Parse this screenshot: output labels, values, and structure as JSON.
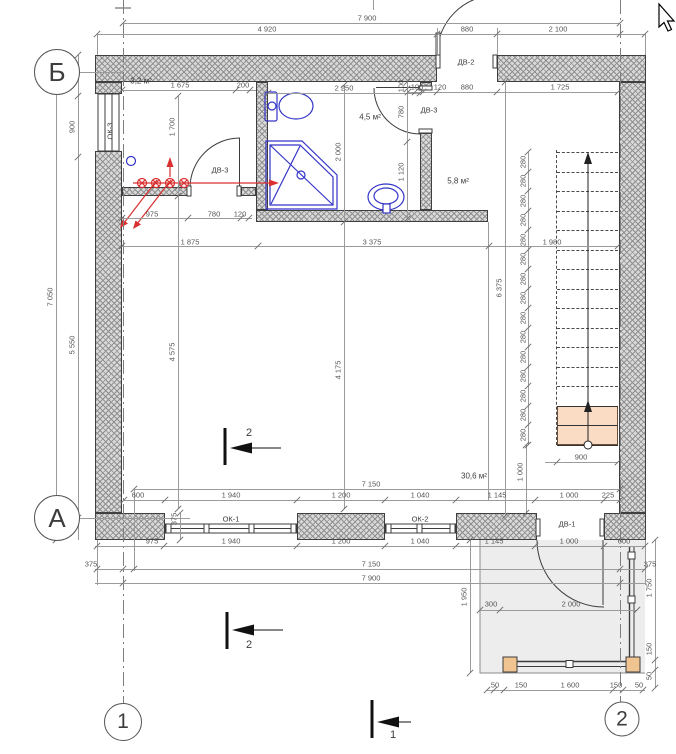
{
  "drawing": {
    "title": "План первого этажа",
    "axis_bubbles": [
      {
        "label": "Б",
        "x": 57,
        "y": 72,
        "d": 44,
        "fs": 26
      },
      {
        "label": "А",
        "x": 57,
        "y": 518,
        "d": 44,
        "fs": 26
      },
      {
        "label": "1",
        "x": 123,
        "y": 722,
        "d": 36,
        "fs": 21
      },
      {
        "label": "2",
        "x": 622,
        "y": 719,
        "d": 33,
        "fs": 21
      }
    ],
    "rooms": [
      {
        "label": "3,2 м²",
        "x": 141,
        "y": 81
      },
      {
        "label": "4,5 м²",
        "x": 370,
        "y": 117
      },
      {
        "label": "5,8 м²",
        "x": 458,
        "y": 181
      },
      {
        "label": "30,6 м²",
        "x": 474,
        "y": 476
      }
    ],
    "windows": [
      {
        "label": "ОК-1",
        "x": 231,
        "y": 519,
        "rot": false
      },
      {
        "label": "ОК-2",
        "x": 420,
        "y": 519,
        "rot": false
      },
      {
        "label": "ОК-3",
        "x": 110,
        "y": 131,
        "rot": true
      }
    ],
    "doors": [
      {
        "label": "ДВ-1",
        "x": 567,
        "y": 524
      },
      {
        "label": "ДВ-2",
        "x": 466,
        "y": 62
      },
      {
        "label": "ДВ-3",
        "x": 429,
        "y": 110
      },
      {
        "label": "ДВ-3",
        "x": 220,
        "y": 170
      }
    ],
    "section_marks": [
      {
        "label": "2",
        "x": 249,
        "y": 433
      },
      {
        "label": "2",
        "x": 249,
        "y": 645
      },
      {
        "label": "1",
        "x": 393,
        "y": 735
      }
    ],
    "stair_tread_dim": "280",
    "dim_labels": [
      {
        "t": "7 900",
        "x": 367,
        "y": 18
      },
      {
        "t": "4 920",
        "x": 267,
        "y": 29
      },
      {
        "t": "880",
        "x": 467,
        "y": 29
      },
      {
        "t": "2 100",
        "x": 558,
        "y": 29
      },
      {
        "t": "1 675",
        "x": 180,
        "y": 85
      },
      {
        "t": "200",
        "x": 243,
        "y": 85
      },
      {
        "t": "2 250",
        "x": 344,
        "y": 88
      },
      {
        "t": "100",
        "x": 417,
        "y": 87
      },
      {
        "t": "120",
        "x": 440,
        "y": 87
      },
      {
        "t": "880",
        "x": 467,
        "y": 87
      },
      {
        "t": "1 725",
        "x": 560,
        "y": 87
      },
      {
        "t": "975",
        "x": 152,
        "y": 214
      },
      {
        "t": "780",
        "x": 214,
        "y": 214
      },
      {
        "t": "120",
        "x": 240,
        "y": 214
      },
      {
        "t": "1 875",
        "x": 190,
        "y": 242
      },
      {
        "t": "3 375",
        "x": 372,
        "y": 242
      },
      {
        "t": "1 980",
        "x": 552,
        "y": 242
      },
      {
        "t": "7 150",
        "x": 371,
        "y": 484
      },
      {
        "t": "600",
        "x": 138,
        "y": 495
      },
      {
        "t": "1 940",
        "x": 231,
        "y": 495
      },
      {
        "t": "1 200",
        "x": 341,
        "y": 495
      },
      {
        "t": "1 040",
        "x": 420,
        "y": 495
      },
      {
        "t": "1 145",
        "x": 497,
        "y": 495
      },
      {
        "t": "1 000",
        "x": 569,
        "y": 495
      },
      {
        "t": "225",
        "x": 608,
        "y": 495
      },
      {
        "t": "900",
        "x": 581,
        "y": 457
      },
      {
        "t": "975",
        "x": 152,
        "y": 541
      },
      {
        "t": "1 940",
        "x": 231,
        "y": 541
      },
      {
        "t": "1 200",
        "x": 341,
        "y": 541
      },
      {
        "t": "1 040",
        "x": 420,
        "y": 541
      },
      {
        "t": "1 145",
        "x": 494,
        "y": 541
      },
      {
        "t": "1 000",
        "x": 569,
        "y": 541
      },
      {
        "t": "600",
        "x": 624,
        "y": 541
      },
      {
        "t": "375",
        "x": 91,
        "y": 564
      },
      {
        "t": "7 150",
        "x": 371,
        "y": 564
      },
      {
        "t": "375",
        "x": 650,
        "y": 564
      },
      {
        "t": "7 900",
        "x": 371,
        "y": 578
      },
      {
        "t": "300",
        "x": 491,
        "y": 604
      },
      {
        "t": "2 000",
        "x": 571,
        "y": 604
      },
      {
        "t": "50",
        "x": 495,
        "y": 685
      },
      {
        "t": "150",
        "x": 521,
        "y": 685
      },
      {
        "t": "1 600",
        "x": 570,
        "y": 685
      },
      {
        "t": "150",
        "x": 616,
        "y": 685
      },
      {
        "t": "50",
        "x": 639,
        "y": 685
      },
      {
        "t": "7 050",
        "x": 50,
        "y": 297,
        "r": 1
      },
      {
        "t": "600",
        "x": 72,
        "y": 73,
        "r": 1
      },
      {
        "t": "900",
        "x": 72,
        "y": 127,
        "r": 1
      },
      {
        "t": "5 550",
        "x": 72,
        "y": 345,
        "r": 1
      },
      {
        "t": "1 700",
        "x": 172,
        "y": 127,
        "r": 1
      },
      {
        "t": "4 575",
        "x": 172,
        "y": 352,
        "r": 1
      },
      {
        "t": "2 000",
        "x": 338,
        "y": 152,
        "r": 1
      },
      {
        "t": "4 175",
        "x": 338,
        "y": 370,
        "r": 1
      },
      {
        "t": "100",
        "x": 401,
        "y": 86,
        "r": 1
      },
      {
        "t": "780",
        "x": 401,
        "y": 112,
        "r": 1
      },
      {
        "t": "1 120",
        "x": 401,
        "y": 172,
        "r": 1
      },
      {
        "t": "6 375",
        "x": 499,
        "y": 288,
        "r": 1
      },
      {
        "t": "1 000",
        "x": 520,
        "y": 472,
        "r": 1
      },
      {
        "t": "1 950",
        "x": 464,
        "y": 597,
        "r": 1
      },
      {
        "t": "1 750",
        "x": 649,
        "y": 588,
        "r": 1
      },
      {
        "t": "150",
        "x": 649,
        "y": 649,
        "r": 1
      },
      {
        "t": "50",
        "x": 649,
        "y": 676,
        "r": 1
      },
      {
        "t": "375",
        "x": 174,
        "y": 519,
        "r": 1
      }
    ],
    "dim_hlines": [
      {
        "y": 23,
        "x1": 123,
        "x2": 620,
        "ticks": [
          123,
          620
        ]
      },
      {
        "y": 34,
        "x1": 97,
        "x2": 645,
        "ticks": [
          97,
          437,
          497,
          620,
          645
        ]
      },
      {
        "y": 90,
        "x1": 122,
        "x2": 256,
        "ticks": [
          122,
          236,
          250
        ]
      },
      {
        "y": 93,
        "x1": 268,
        "x2": 420,
        "ticks": [
          268,
          420
        ]
      },
      {
        "y": 92,
        "x1": 408,
        "x2": 618,
        "ticks": [
          408,
          415,
          423,
          437,
          497,
          618
        ]
      },
      {
        "y": 218,
        "x1": 122,
        "x2": 252,
        "ticks": [
          122,
          188,
          241,
          249
        ]
      },
      {
        "y": 246,
        "x1": 122,
        "x2": 618,
        "ticks": [
          122,
          258,
          489,
          618
        ]
      },
      {
        "y": 462,
        "x1": 545,
        "x2": 618,
        "ticks": [
          557,
          618
        ]
      },
      {
        "y": 489,
        "x1": 134,
        "x2": 620,
        "ticks": [
          134,
          620
        ]
      },
      {
        "y": 500,
        "x1": 124,
        "x2": 620,
        "ticks": [
          124,
          165,
          297,
          385,
          456,
          535,
          604,
          620
        ]
      },
      {
        "y": 546,
        "x1": 95,
        "x2": 645,
        "ticks": [
          97,
          164,
          297,
          385,
          456,
          535,
          604,
          645
        ]
      },
      {
        "y": 569,
        "x1": 95,
        "x2": 645,
        "ticks": [
          97,
          123,
          134,
          620,
          645
        ]
      },
      {
        "y": 583,
        "x1": 95,
        "x2": 645,
        "ticks": [
          123,
          620
        ]
      },
      {
        "y": 610,
        "x1": 480,
        "x2": 637,
        "ticks": [
          480,
          500,
          637
        ]
      },
      {
        "y": 690,
        "x1": 487,
        "x2": 645,
        "ticks": [
          487,
          494,
          504,
          613,
          623,
          643
        ]
      },
      {
        "y": 72,
        "x1": 79,
        "x2": 123,
        "ticks": []
      },
      {
        "y": 518,
        "x1": 80,
        "x2": 190,
        "ticks": []
      }
    ],
    "dim_vlines": [
      {
        "x": 56,
        "y1": 55,
        "y2": 540,
        "ticks": [
          55,
          540
        ]
      },
      {
        "x": 78,
        "y1": 55,
        "y2": 540,
        "ticks": [
          55,
          96,
          157,
          518
        ]
      },
      {
        "x": 178,
        "y1": 96,
        "y2": 509,
        "ticks": [
          96,
          187,
          196,
          509
        ]
      },
      {
        "x": 344,
        "y1": 85,
        "y2": 509,
        "ticks": [
          85,
          222,
          509
        ]
      },
      {
        "x": 407,
        "y1": 82,
        "y2": 219,
        "ticks": [
          82,
          89,
          142,
          219
        ]
      },
      {
        "x": 505,
        "y1": 82,
        "y2": 516,
        "ticks": [
          82,
          516
        ]
      },
      {
        "x": 526,
        "y1": 445,
        "y2": 513,
        "ticks": [
          445,
          513
        ]
      },
      {
        "x": 470,
        "y1": 540,
        "y2": 673,
        "ticks": [
          540,
          673
        ]
      },
      {
        "x": 655,
        "y1": 540,
        "y2": 688,
        "ticks": [
          540,
          660,
          670,
          688
        ]
      },
      {
        "x": 180,
        "y1": 513,
        "y2": 540,
        "ticks": [
          513,
          540
        ]
      },
      {
        "x": 97,
        "y1": 540,
        "y2": 585,
        "ticks": []
      },
      {
        "x": 645,
        "y1": 540,
        "y2": 585,
        "ticks": []
      },
      {
        "x": 134,
        "y1": 489,
        "y2": 571,
        "ticks": []
      },
      {
        "x": 97,
        "y1": 34,
        "y2": 55,
        "ticks": []
      },
      {
        "x": 437,
        "y1": 28,
        "y2": 55,
        "ticks": []
      },
      {
        "x": 497,
        "y1": 28,
        "y2": 55,
        "ticks": []
      },
      {
        "x": 645,
        "y1": 34,
        "y2": 55,
        "ticks": []
      },
      {
        "x": 488,
        "y1": 222,
        "y2": 500,
        "ticks": []
      },
      {
        "x": 373,
        "y1": 0,
        "y2": 10,
        "ticks": []
      }
    ],
    "stairs": {
      "x1": 557,
      "x2": 618,
      "y_first": 152,
      "step": 19.5,
      "n_lines": 16,
      "dim_line_x": 528,
      "label_x": 523
    },
    "colors": {
      "wall_hatch": "#d9d9d9",
      "accent_red": "#d93030",
      "fixture_blue": "#3434c8",
      "step_fill": "#fadcc4",
      "porch_fill": "#ededed",
      "post_fill": "#f0c490",
      "line_gray": "#9b9b9b"
    }
  }
}
